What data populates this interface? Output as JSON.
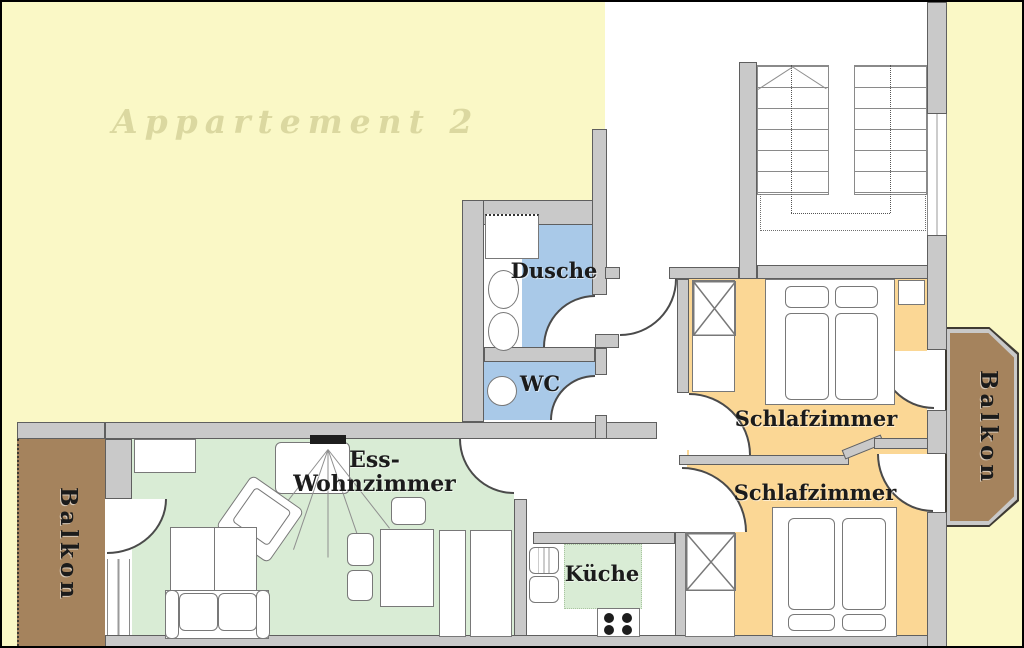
{
  "title": {
    "text": "Appartement 2"
  },
  "rooms": {
    "dusche": {
      "label": "Dusche"
    },
    "wc": {
      "label": "WC"
    },
    "wohnzimmer": {
      "line1": "Ess-",
      "line2": "Wohnzimmer"
    },
    "kueche": {
      "label": "Küche"
    },
    "schlafzimmer_top": {
      "label": "Schlafzimmer"
    },
    "schlafzimmer_bottom": {
      "label": "Schlafzimmer"
    },
    "balkon_left": {
      "label": "Balkon"
    },
    "balkon_right": {
      "label": "Balkon"
    }
  },
  "colors": {
    "background_yellow": "#FAF8C6",
    "title_text": "#DBD8A0",
    "wall_fill": "#C9C9C9",
    "wall_edge": "#5F5F5F",
    "bath_blue": "#A9C9E8",
    "floor_green": "#D9ECD5",
    "bedroom_orange": "#FBD795",
    "balcony_brown": "#A5835D",
    "balcony_border": "#3E3A32",
    "label_text": "#1B1B1B"
  }
}
